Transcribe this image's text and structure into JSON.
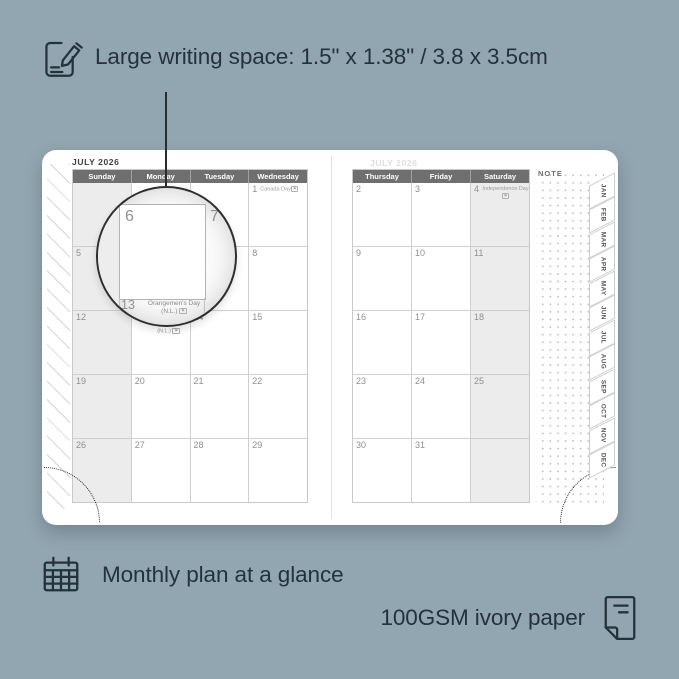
{
  "colors": {
    "background": "#92a6b1",
    "ink": "#24323b",
    "header_bar": "#6f6f6f",
    "weekend_shade": "#ececec",
    "page": "#ffffff"
  },
  "icons": {
    "top": "pencil-note-icon",
    "monthly": "calendar-grid-icon",
    "paper": "paper-sheet-icon",
    "holiday_chip": "⚑"
  },
  "annotations": {
    "writing_space": "Large writing space: 1.5\" x 1.38\" / 3.8 x 3.5cm",
    "monthly_plan": "Monthly plan at a glance",
    "paper": "100GSM ivory paper"
  },
  "planner": {
    "month_title": "JULY 2026",
    "note_label": "NOTE",
    "left_page": {
      "headers": [
        "Sunday",
        "Monday",
        "Tuesday",
        "Wednesday"
      ],
      "weekend_col": 0,
      "rows": [
        [
          {
            "day": ""
          },
          {
            "day": ""
          },
          {
            "day": ""
          },
          {
            "day": "1",
            "holiday": "Canada Day"
          }
        ],
        [
          {
            "day": "5"
          },
          {
            "day": "6"
          },
          {
            "day": "7"
          },
          {
            "day": "8"
          }
        ],
        [
          {
            "day": "12"
          },
          {
            "day": "13",
            "holiday": "Orangemen's Day",
            "holiday2": "(N.L.)"
          },
          {
            "day": "14"
          },
          {
            "day": "15"
          }
        ],
        [
          {
            "day": "19"
          },
          {
            "day": "20"
          },
          {
            "day": "21"
          },
          {
            "day": "22"
          }
        ],
        [
          {
            "day": "26"
          },
          {
            "day": "27"
          },
          {
            "day": "28"
          },
          {
            "day": "29"
          }
        ]
      ]
    },
    "right_page": {
      "headers": [
        "Thursday",
        "Friday",
        "Saturday"
      ],
      "weekend_col": 2,
      "rows": [
        [
          {
            "day": "2"
          },
          {
            "day": "3"
          },
          {
            "day": "4",
            "holiday": "Independence Day"
          }
        ],
        [
          {
            "day": "9"
          },
          {
            "day": "10"
          },
          {
            "day": "11"
          }
        ],
        [
          {
            "day": "16"
          },
          {
            "day": "17"
          },
          {
            "day": "18"
          }
        ],
        [
          {
            "day": "23"
          },
          {
            "day": "24"
          },
          {
            "day": "25"
          }
        ],
        [
          {
            "day": "30"
          },
          {
            "day": "31"
          },
          {
            "day": ""
          }
        ]
      ]
    },
    "month_tabs": [
      "JAN",
      "FEB",
      "MAR",
      "APR",
      "MAY",
      "JUN",
      "JUL",
      "AUG",
      "SEP",
      "OCT",
      "NOV",
      "DEC"
    ],
    "magnifier": {
      "left_day": "6",
      "right_day": "7",
      "footer_day": "13",
      "footer_line1": "Orangemen's Day",
      "footer_line2": "(N.L.)"
    }
  }
}
